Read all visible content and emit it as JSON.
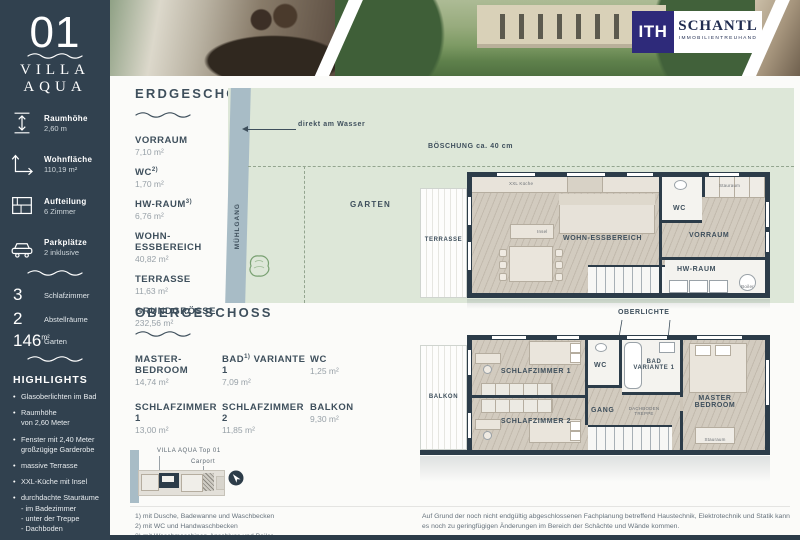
{
  "colors": {
    "navy": "#31414f",
    "wall": "#2c3c49",
    "plan_green": "#dde7d8",
    "water": "#a8bcc6",
    "logo_purple": "#2e2a7a"
  },
  "sidebar": {
    "number": "01",
    "title1": "VILLA",
    "title2": "AQUA",
    "specs": [
      {
        "icon": "room-height-icon",
        "label": "Raumhöhe",
        "value": "2,60 m"
      },
      {
        "icon": "living-area-icon",
        "label": "Wohnfläche",
        "value": "110,19 m²"
      },
      {
        "icon": "layout-icon",
        "label": "Aufteilung",
        "value": "6 Zimmer"
      },
      {
        "icon": "car-icon",
        "label": "Parkplätze",
        "value": "2 inklusive"
      }
    ],
    "counts": [
      {
        "value": "3",
        "unit": "",
        "label": "Schlafzimmer"
      },
      {
        "value": "2",
        "unit": "",
        "label": "Abstellräume"
      },
      {
        "value": "146",
        "unit": "m²",
        "label": "Garten"
      }
    ],
    "highlights_title": "HIGHLIGHTS",
    "highlights": [
      "Glasoberlichten im Bad",
      "Raumhöhe\nvon 2,60 Meter",
      "Fenster mit 2,40 Meter\ngroßzügige Garderobe",
      "massive Terrasse",
      "XXL-Küche mit Insel",
      "durchdachte Stauräume\n- im Badezimmer\n- unter der Treppe\n- Dachboden"
    ]
  },
  "logo": {
    "mark": "ITH",
    "name": "SCHANTL",
    "tagline": "IMMOBILIENTREUHAND"
  },
  "erdgeschoss": {
    "heading": "ERDGESCHOSS",
    "rooms": [
      {
        "name": "VORRAUM",
        "sup": "",
        "area": "7,10 m²"
      },
      {
        "name": "WC",
        "sup": "2)",
        "area": "1,70 m²"
      },
      {
        "name": "HW-RAUM",
        "sup": "3)",
        "area": "6,76 m²"
      },
      {
        "name": "WOHN-ESSBEREICH",
        "sup": "",
        "area": "40,82 m²"
      },
      {
        "name": "TERRASSE",
        "sup": "",
        "area": "11,63 m²"
      },
      {
        "name": "GRUNDGRÖSSE",
        "sup": "",
        "area": "232,56 m²"
      }
    ]
  },
  "obergeschoss": {
    "heading": "OBERGESCHOSS",
    "rooms": [
      {
        "name": "MASTER-BEDROOM",
        "sup": "",
        "name2": "",
        "area": "14,74 m²"
      },
      {
        "name": "BAD",
        "sup": "1)",
        "name2": " VARIANTE 1",
        "area": "7,09 m²"
      },
      {
        "name": "WC",
        "sup": "",
        "name2": "",
        "area": "1,25 m²"
      },
      {
        "name": "SCHLAFZIMMER 1",
        "sup": "",
        "name2": "",
        "area": "13,00 m²"
      },
      {
        "name": "SCHLAFZIMMER 2",
        "sup": "",
        "name2": "",
        "area": "11,85 m²"
      },
      {
        "name": "BALKON",
        "sup": "",
        "name2": "",
        "area": "9,30 m²"
      }
    ]
  },
  "siteplan": {
    "muehlgang": "MÜHLGANG",
    "direkt_am_wasser": "direkt am Wasser",
    "boeschung": "BÖSCHUNG ca. 40 cm",
    "garten": "GARTEN"
  },
  "plan_eg": {
    "terrasse": "TERRASSE",
    "kueche": "XXL Küche",
    "insel": "Insel",
    "wohn_essbereich": "WOHN-ESSBEREICH",
    "wc": "WC",
    "vorraum": "VORRAUM",
    "hw_raum": "HW-RAUM",
    "stauraum": "Stauraum",
    "boiler": "Boiler"
  },
  "plan_og": {
    "oberlichte": "OBERLICHTE",
    "balkon": "BALKON",
    "schlafzimmer1": "SCHLAFZIMMER 1",
    "schlafzimmer2": "SCHLAFZIMMER 2",
    "wc": "WC",
    "bad": "BAD\nVARIANTE 1",
    "gang": "GANG",
    "dachboden_treppe": "DACHBODEN\nTREPPE",
    "master_bedroom": "MASTER\nBEDROOM",
    "stauraum": "Stauraum"
  },
  "miniplan": {
    "title": "VILLA AQUA Top 01",
    "carport": "Carport"
  },
  "footnotes": [
    "1) mit Dusche, Badewanne und Waschbecken",
    "2) mit WC und Handwaschbecken",
    "3) mit Waschmaschinen-Anschluss und Boiler"
  ],
  "disclaimer": "Auf Grund der noch nicht endgültig abgeschlossenen Fachplanung betreffend Haustechnik, Elektrotechnik und Statik kann es noch zu geringfügigen Änderungen im Bereich der Schächte und Wände kommen."
}
